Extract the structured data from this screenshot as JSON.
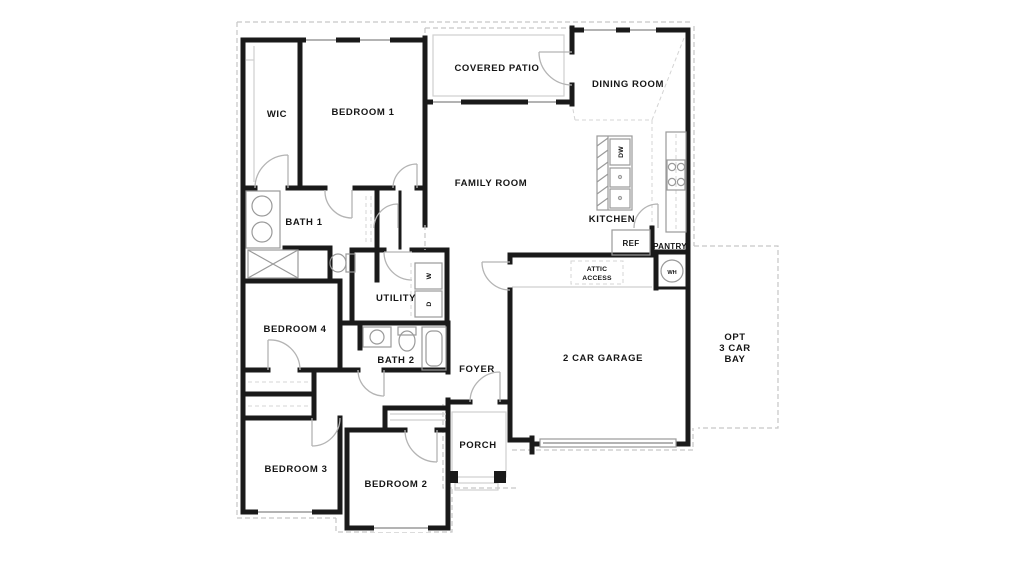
{
  "plan": {
    "type": "residential-floor-plan",
    "colors": {
      "wall": "#1a1a1a",
      "background": "#ffffff",
      "guide_line": "#c6c6c6",
      "text": "#161616"
    },
    "rooms": {
      "wic": "WIC",
      "bedroom1": "BEDROOM 1",
      "covered_patio": "COVERED PATIO",
      "dining_room": "DINING ROOM",
      "family_room": "FAMILY ROOM",
      "bath1": "BATH 1",
      "kitchen": "KITCHEN",
      "dishwasher": "DW",
      "refrigerator": "REF",
      "pantry": "PANTRY",
      "attic_line1": "ATTIC",
      "attic_line2": "ACCESS",
      "water_heater": "WH",
      "utility": "UTILITY",
      "washer": "W",
      "dryer": "D",
      "bedroom4": "BEDROOM 4",
      "bath2": "BATH 2",
      "foyer": "FOYER",
      "garage": "2 CAR GARAGE",
      "opt_bay_line1": "OPT",
      "opt_bay_line2": "3 CAR",
      "opt_bay_line3": "BAY",
      "bedroom3": "BEDROOM 3",
      "bedroom2": "BEDROOM 2",
      "porch": "PORCH"
    }
  }
}
